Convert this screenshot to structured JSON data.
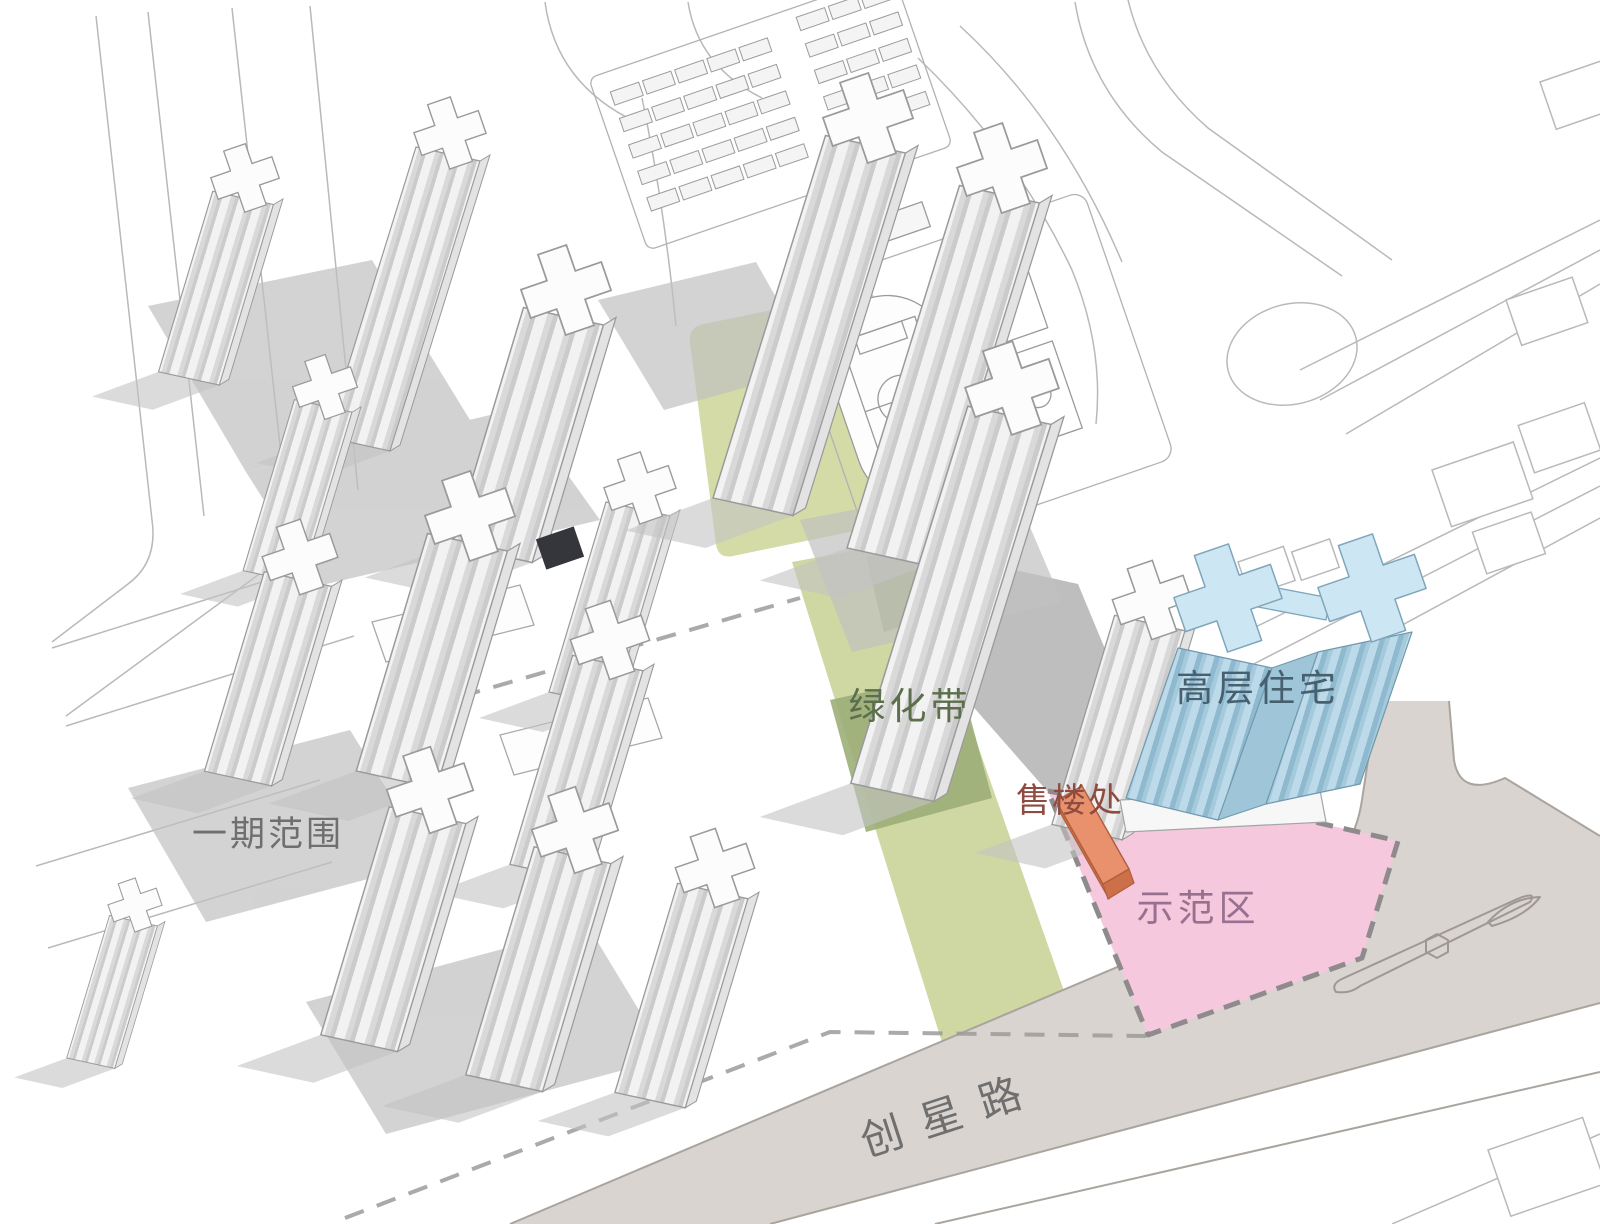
{
  "figure": {
    "type": "architectural-site-plan-axonometric",
    "labels": {
      "phase1": "一期范围",
      "green_belt": "绿化带",
      "highrise": "高层住宅",
      "sales_office": "售楼处",
      "demo_area": "示范区",
      "road": "创星路"
    },
    "colors": {
      "background": "#ffffff",
      "green_patch": "#d4dba6",
      "green_belt_light": "#cfd7a2",
      "green_belt_shadow": "#9cae78",
      "plaza_shadow": "#b3b3b3",
      "pink_demo": "#f5c8dd",
      "pink_border": "#8f8a8c",
      "blue_roof": "#cde6f3",
      "blue_facade_dark": "#9fc6d8",
      "blue_stroke": "#6f98ad",
      "orange_roof": "#e9916c",
      "orange_side": "#cd6f49",
      "road_fill": "#dad4d0",
      "building_white": "#fbfbfb",
      "shadow_gray": "#c0c0c0",
      "line_gray": "#9a9a9a",
      "text_gray": "#6f6f6f",
      "text_green": "#5c6e4c",
      "text_blue": "#47606f",
      "text_red": "#8e4b40",
      "text_purple": "#97718f"
    }
  }
}
